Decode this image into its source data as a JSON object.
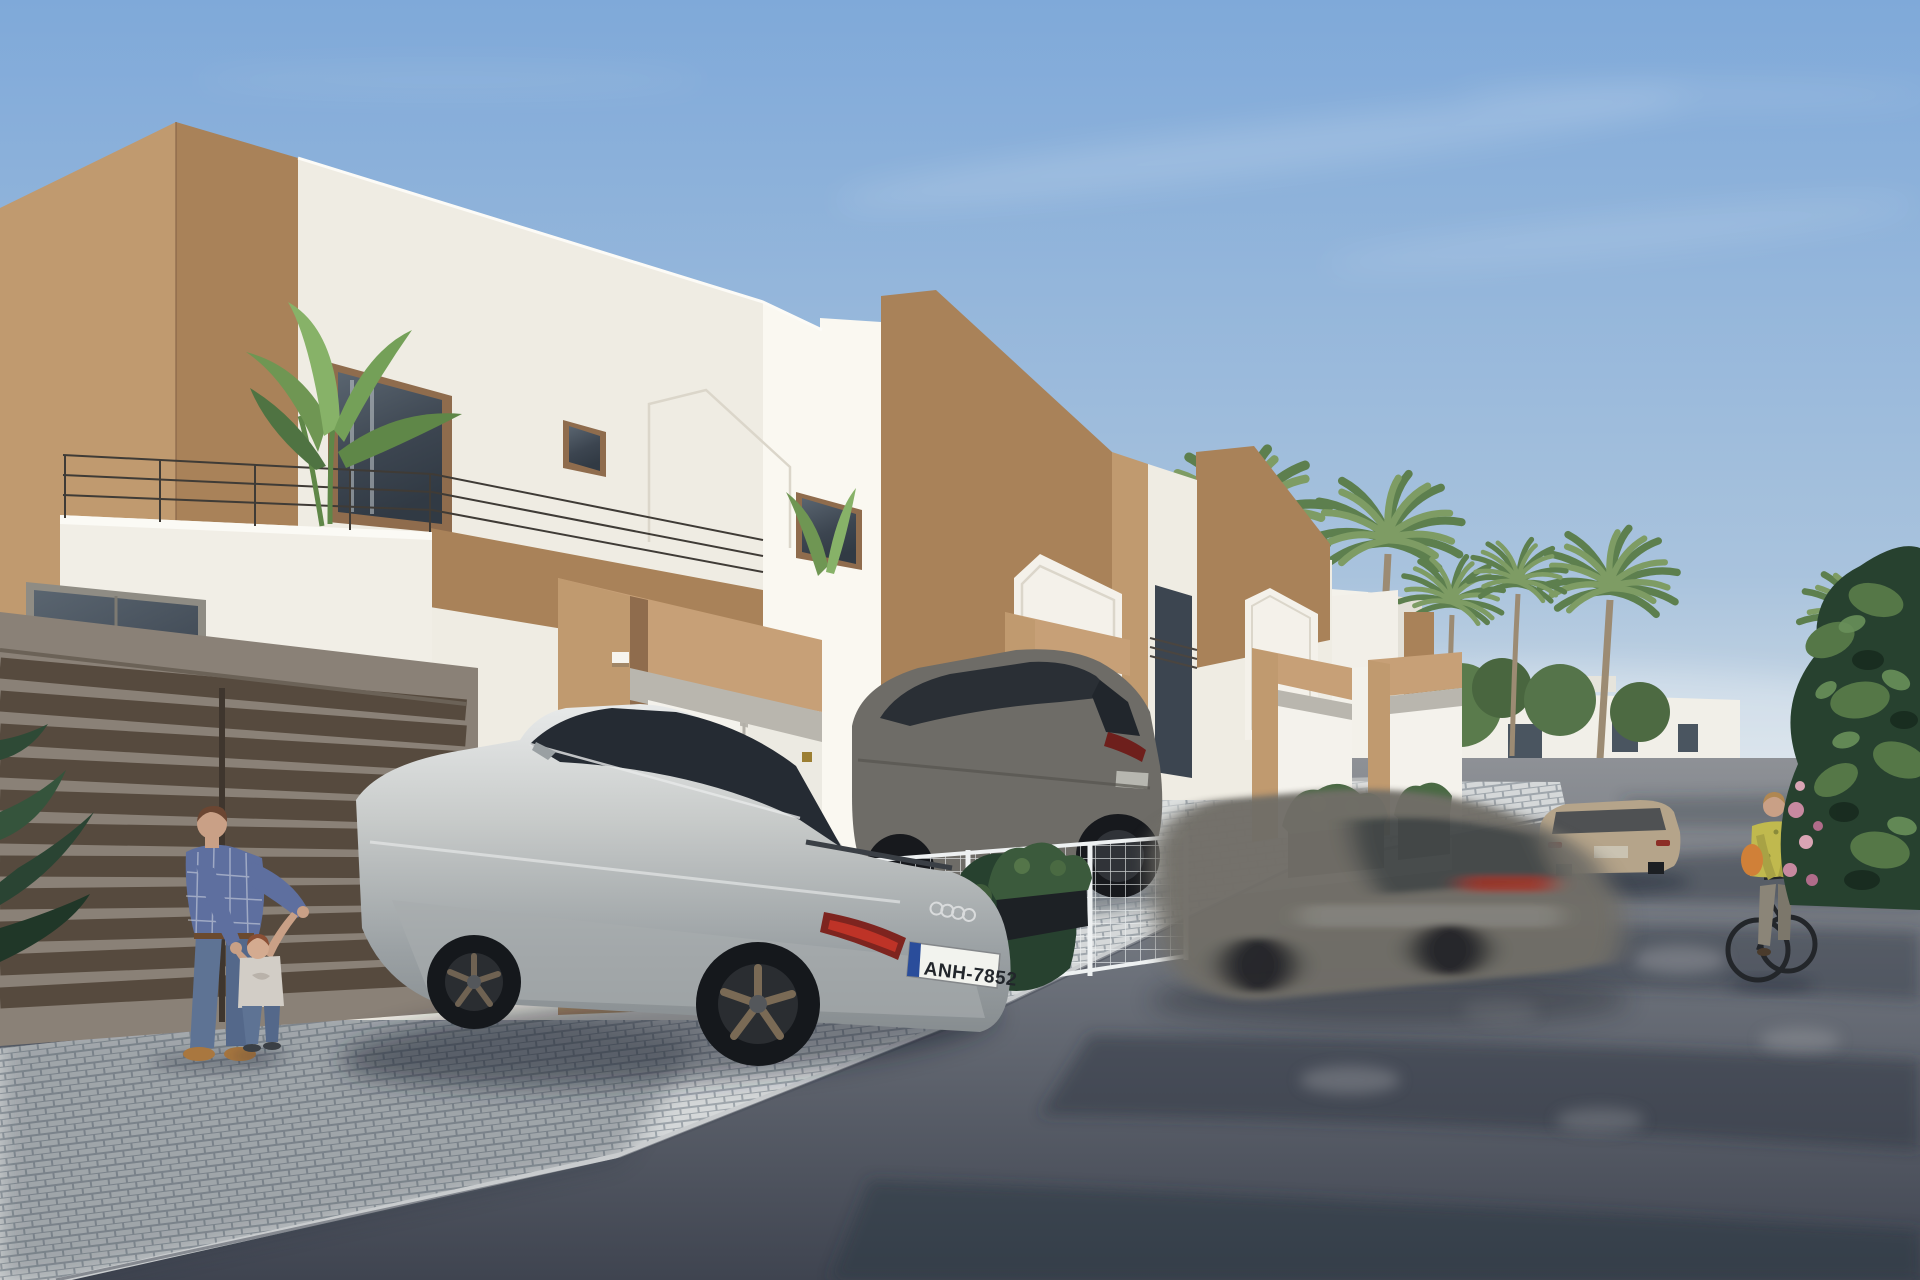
{
  "scene": {
    "type": "3D architectural rendering",
    "description": "Sunny street of new-build white townhouses with tan accent volumes; a silver sedan and a dark SUV are parked on cobbled driveways, a blurred car drives past, a father plays with his toddler by a slatted gate and a woman cycles up the street lined with palm trees",
    "time_of_day": "sunny daytime",
    "sky": "clear blue with faint wispy clouds"
  },
  "palette": {
    "sky_top": "#7fa9d9",
    "sky_mid": "#a9c3dd",
    "sky_horizon": "#d9e2e8",
    "wall_white": "#efece3",
    "wall_white_bright": "#faf8f1",
    "wall_white_shade": "#e3e0d7",
    "accent_brown": "#a98259",
    "accent_brown_light": "#c09a6f",
    "accent_brown_dark": "#8f6c4d",
    "portico_tan": "#c7a077",
    "door_white": "#f4f2ec",
    "glass_dark": "#3c4550",
    "road_light": "#8e9196",
    "road_dark": "#3f4450",
    "paver_light": "#dadcdd",
    "paver_gap": "#9aa2a8",
    "fence_dark": "#564a3e",
    "mesh_white": "#eef1f2",
    "car_silver": "#c8cbca",
    "car_silver_shade": "#9ba1a4",
    "suv_gray": "#6e6c67",
    "car_blur_gray": "#716e68",
    "suv_beige": "#b5a48a",
    "taillight_red": "#c23528",
    "plate_white": "#f2f3ee",
    "plate_blue": "#2a4d9b",
    "palm_green": "#7e9c64",
    "palm_green_dark": "#5d7f4e",
    "trunk_brown": "#9c8b73",
    "bush_green_dark": "#27412f",
    "bush_green": "#557747",
    "flower_pink": "#c789a0",
    "shirt_blue": "#5e6f9f",
    "jeans_blue": "#5e7394",
    "skin": "#c9a086",
    "shoe_tan": "#a9773f",
    "top_yellow": "#c0b94e",
    "bag_orange": "#d08038",
    "pants_gray": "#8b8578",
    "gold": "#9c7f33"
  },
  "vehicles": [
    {
      "name": "silver sportback sedan",
      "state": "parked on cobbled driveway",
      "license_plate": "ANH-7852"
    },
    {
      "name": "dark gray SUV",
      "state": "parked behind white wire-mesh fence",
      "license_plate": ""
    },
    {
      "name": "gray hatchback",
      "state": "driving past, motion-blurred",
      "license_plate": ""
    },
    {
      "name": "beige crossover",
      "state": "parked along the street",
      "license_plate": ""
    }
  ],
  "people": [
    {
      "name": "father",
      "detail": "man in blue plaid shirt, jeans and tan shoes holding his toddler's hands"
    },
    {
      "name": "toddler",
      "detail": "small child in light t-shirt and jeans learning to walk"
    },
    {
      "name": "cyclist",
      "detail": "woman in yellow patterned top with orange bag riding a dark bicycle"
    }
  ],
  "buildings": [
    {
      "name": "townhouse-1",
      "detail": "white facade, tan corner volume, balcony with banana plant, gable-outline relief, tan entrance portico with two white doors and small gold number plaques"
    },
    {
      "name": "townhouse-2",
      "detail": "large tan upper volume over white base, white gable parapet, tan entrance portico"
    },
    {
      "name": "townhouse-3",
      "detail": "receding identical unit with gable parapet and portico"
    },
    {
      "name": "townhouse-4",
      "detail": "farthest unit, portico partially visible"
    },
    {
      "name": "background-villas",
      "detail": "distant white modern houses with dark windows among palm trees"
    }
  ],
  "vegetation": [
    "banana plant on first balcony",
    "palm trees along the street",
    "large foreground shrub with pink flowers at right",
    "hedge and black planter boxes with shrubs",
    "houseplant leaves at left edge"
  ],
  "street": {
    "sidewalk": "light cobblestone pavers, partly in shade",
    "road": "dark asphalt with dappled tree shadows"
  }
}
